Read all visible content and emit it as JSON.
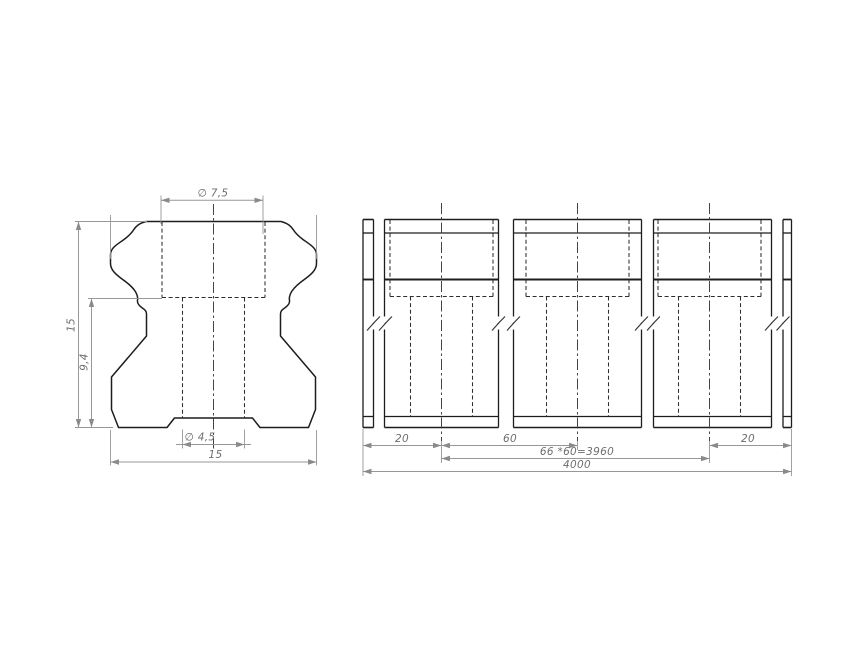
{
  "drawing": {
    "type": "technical-drawing",
    "views": {
      "cross_section": {
        "dim_top_diameter": "∅ 7,5",
        "dim_overall_height": "15",
        "dim_partial_height": "9,4",
        "dim_hole_diameter": "∅ 4,5",
        "dim_overall_width": "15"
      },
      "side_view": {
        "dim_end_offset_left": "20",
        "dim_pitch": "60",
        "dim_end_offset_right": "20",
        "dim_pitch_total": "66 *60=3960",
        "dim_overall_length": "4000"
      }
    },
    "colors": {
      "background": "#ffffff",
      "object_lines": "#1d1d1d",
      "hidden_lines": "#2e2e2e",
      "dimension_lines": "#979797",
      "dimension_text": "#6e6e6e"
    }
  }
}
